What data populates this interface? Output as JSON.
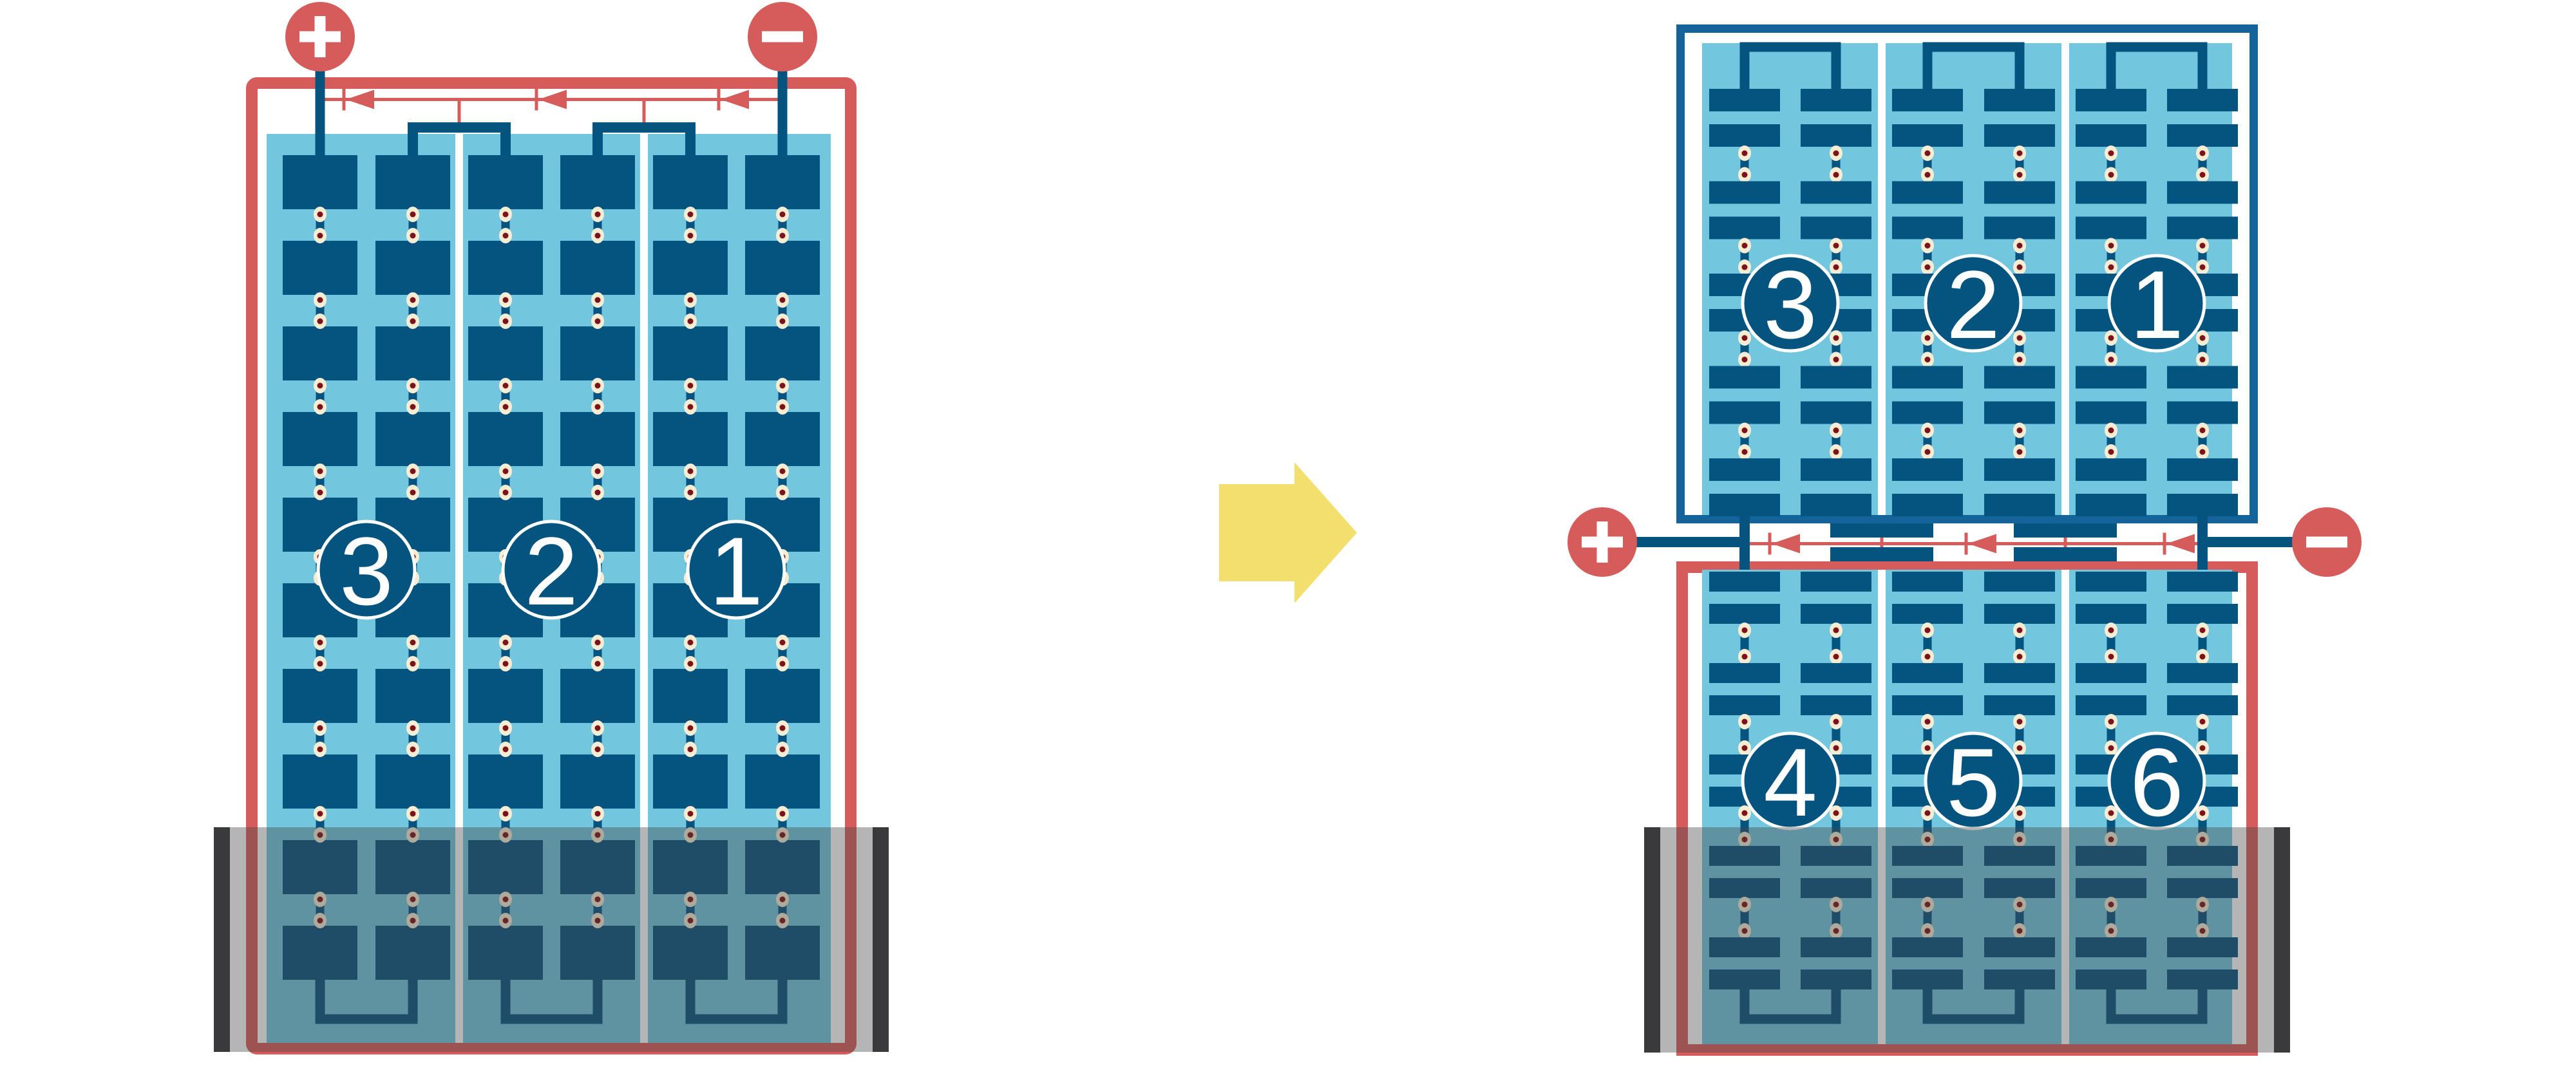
{
  "diagram": {
    "colors": {
      "red": "#D55C5B",
      "dark_blue": "#05537F",
      "panel_blue": "#15639B",
      "light_blue": "#72C6DE",
      "cream": "#F7EDD5",
      "dot_red": "#7E1317",
      "yellow": "#F3DF6D",
      "white": "#FFFFFF",
      "clamp_gray": "#3A3A3C",
      "overlay_gray": "rgba(70,70,70,0.40)"
    },
    "left_battery": {
      "positive_terminal": "+",
      "negative_terminal": "−",
      "cells": [
        "3",
        "2",
        "1"
      ]
    },
    "transform_arrow": {
      "direction": "right"
    },
    "right_battery": {
      "positive_terminal": "+",
      "negative_terminal": "−",
      "top_row_cells": [
        "3",
        "2",
        "1"
      ],
      "bottom_row_cells": [
        "4",
        "5",
        "6"
      ]
    }
  }
}
